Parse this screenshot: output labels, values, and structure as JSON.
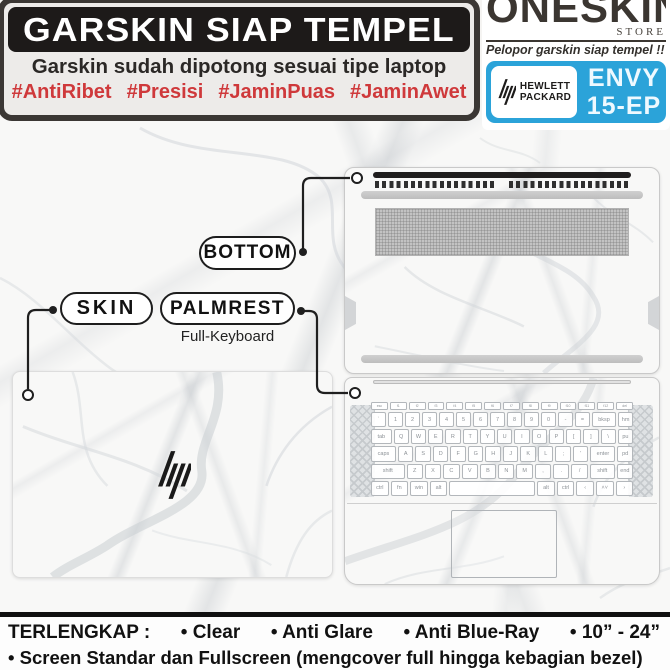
{
  "header": {
    "title": "GARSKIN SIAP TEMPEL",
    "subtitle": "Garskin sudah dipotong sesuai tipe laptop",
    "hashtags": [
      "#AntiRibet",
      "#Presisi",
      "#JaminPuas",
      "#JaminAwet"
    ]
  },
  "brand": {
    "store_name": "ONESKIN",
    "store_sub": "STORE",
    "tagline": "Pelopor garskin siap tempel !!",
    "maker_line1": "HEWLETT",
    "maker_line2": "PACKARD",
    "model_line1": "ENVY",
    "model_line2": "15-EP",
    "badge_color": "#2ba3d9"
  },
  "callouts": {
    "bottom": "BOTTOM",
    "skin": "SKIN",
    "palmrest": "PALMREST",
    "palmrest_sub": "Full-Keyboard"
  },
  "footer": {
    "heading": "TERLENGKAP :",
    "items": [
      "• Clear",
      "• Anti Glare",
      "• Anti Blue-Ray",
      "• 10” - 24”"
    ],
    "line2": "• Screen Standar dan Fullscreen (mengcover full hingga kebagian bezel)"
  },
  "colors": {
    "hashtag_red": "#cf393b",
    "title_bar_black": "#1d1a19",
    "badge_blue": "#2ba3d9",
    "marble_base": "#f8f8f7"
  },
  "keyboard": {
    "rows": [
      [
        {
          "l": "esc"
        },
        {
          "l": "f1"
        },
        {
          "l": "f2"
        },
        {
          "l": "f3"
        },
        {
          "l": "f4"
        },
        {
          "l": "f5"
        },
        {
          "l": "f6"
        },
        {
          "l": "f7"
        },
        {
          "l": "f8"
        },
        {
          "l": "f9"
        },
        {
          "l": "f10"
        },
        {
          "l": "f11"
        },
        {
          "l": "f12"
        },
        {
          "l": "del"
        }
      ],
      [
        {
          "l": "`"
        },
        {
          "l": "1"
        },
        {
          "l": "2"
        },
        {
          "l": "3"
        },
        {
          "l": "4"
        },
        {
          "l": "5"
        },
        {
          "l": "6"
        },
        {
          "l": "7"
        },
        {
          "l": "8"
        },
        {
          "l": "9"
        },
        {
          "l": "0"
        },
        {
          "l": "-"
        },
        {
          "l": "="
        },
        {
          "l": "bksp",
          "f": 1.7
        },
        {
          "l": "hm"
        }
      ],
      [
        {
          "l": "tab",
          "f": 1.4
        },
        {
          "l": "Q"
        },
        {
          "l": "W"
        },
        {
          "l": "E"
        },
        {
          "l": "R"
        },
        {
          "l": "T"
        },
        {
          "l": "Y"
        },
        {
          "l": "U"
        },
        {
          "l": "I"
        },
        {
          "l": "O"
        },
        {
          "l": "P"
        },
        {
          "l": "["
        },
        {
          "l": "]"
        },
        {
          "l": "\\"
        },
        {
          "l": "pu"
        }
      ],
      [
        {
          "l": "caps",
          "f": 1.7
        },
        {
          "l": "A"
        },
        {
          "l": "S"
        },
        {
          "l": "D"
        },
        {
          "l": "F"
        },
        {
          "l": "G"
        },
        {
          "l": "H"
        },
        {
          "l": "J"
        },
        {
          "l": "K"
        },
        {
          "l": "L"
        },
        {
          "l": ";"
        },
        {
          "l": "'"
        },
        {
          "l": "enter",
          "f": 1.7
        },
        {
          "l": "pd"
        }
      ],
      [
        {
          "l": "shift",
          "f": 2.2
        },
        {
          "l": "Z"
        },
        {
          "l": "X"
        },
        {
          "l": "C"
        },
        {
          "l": "V"
        },
        {
          "l": "B"
        },
        {
          "l": "N"
        },
        {
          "l": "M"
        },
        {
          "l": ","
        },
        {
          "l": "."
        },
        {
          "l": "/"
        },
        {
          "l": "shift",
          "f": 1.6
        },
        {
          "l": "end"
        }
      ],
      [
        {
          "l": "ctrl"
        },
        {
          "l": "fn"
        },
        {
          "l": "win"
        },
        {
          "l": "alt"
        },
        {
          "l": "",
          "f": 5.4
        },
        {
          "l": "alt"
        },
        {
          "l": "ctrl"
        },
        {
          "l": "‹"
        },
        {
          "l": "˄˅"
        },
        {
          "l": "›"
        }
      ]
    ]
  }
}
